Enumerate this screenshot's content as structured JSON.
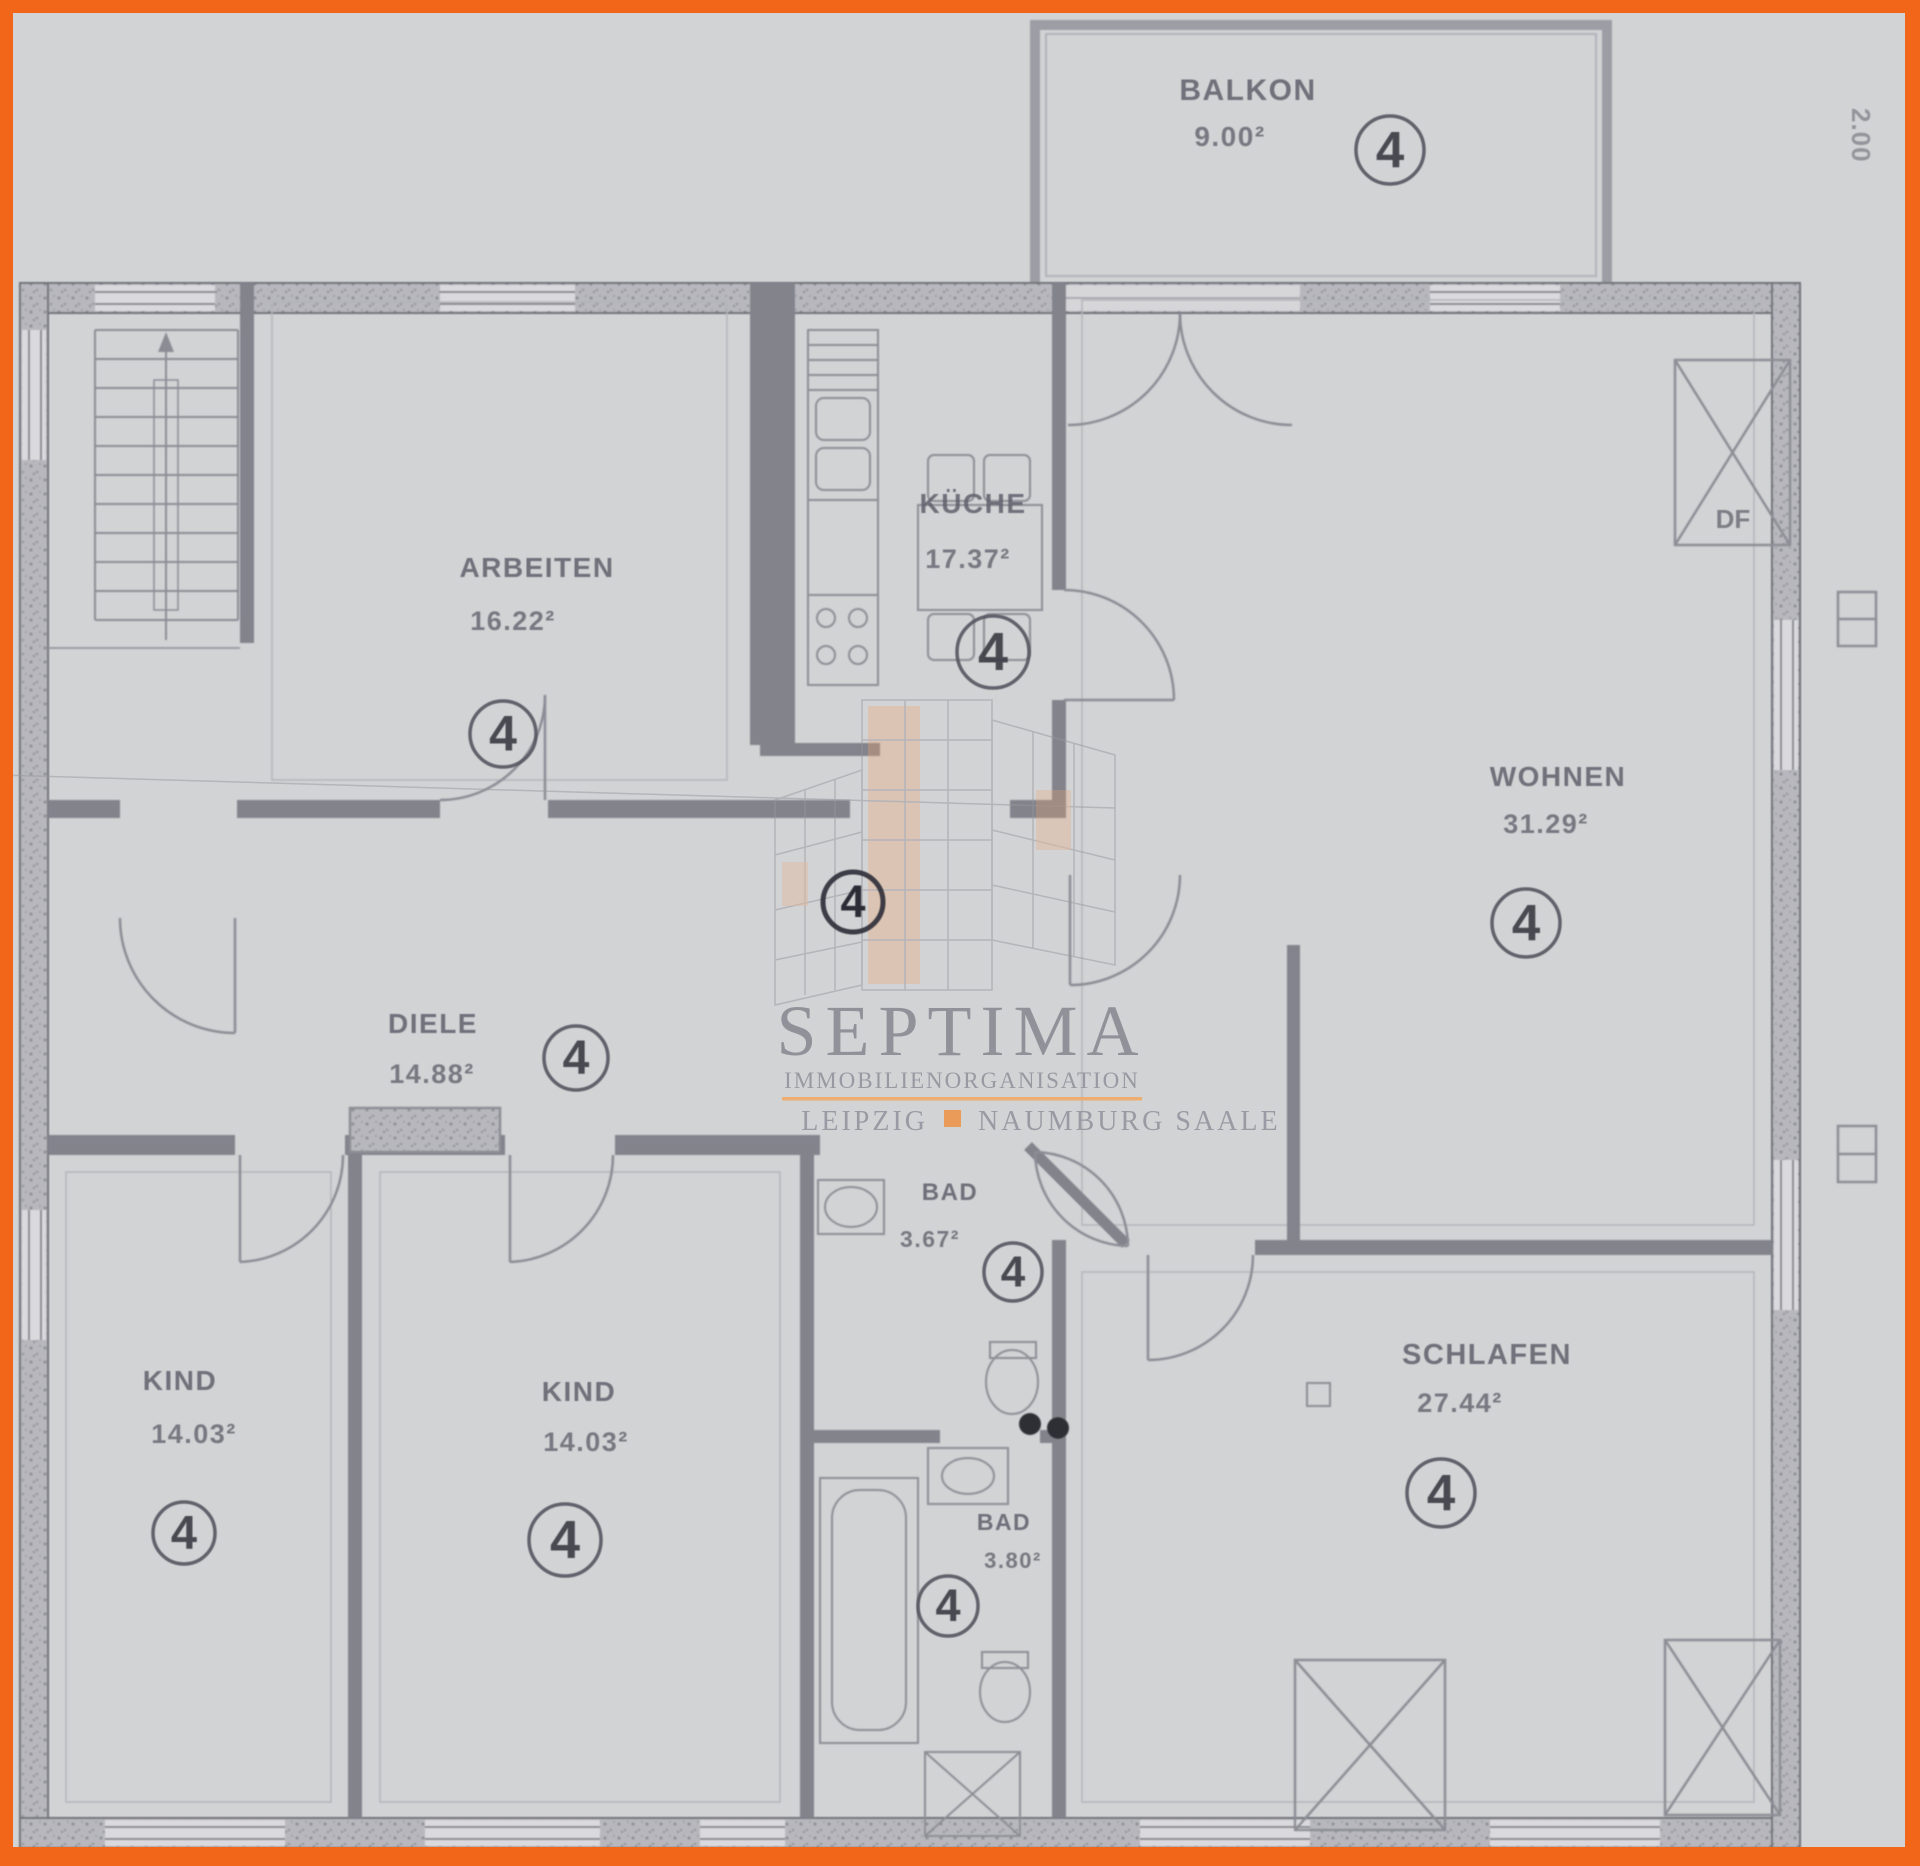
{
  "page": {
    "background": "#d2d3d5",
    "border_color": "#f2661a"
  },
  "plan": {
    "unit_number": "4",
    "side_dimension": "2.00",
    "duct_label": "DF",
    "rooms": [
      {
        "id": "balkon",
        "name": "BALKON",
        "area": "9.00²",
        "label": {
          "x": 1248,
          "y": 100,
          "s": 30
        },
        "area_pos": {
          "x": 1230,
          "y": 146,
          "s": 28
        },
        "circle": {
          "x": 1390,
          "y": 150,
          "r": 34
        }
      },
      {
        "id": "arbeiten",
        "name": "ARBEITEN",
        "area": "16.22²",
        "label": {
          "x": 537,
          "y": 577,
          "s": 28
        },
        "area_pos": {
          "x": 513,
          "y": 630,
          "s": 27
        },
        "circle": {
          "x": 503,
          "y": 734,
          "r": 33
        }
      },
      {
        "id": "kueche",
        "name": "KÜCHE",
        "area": "17.37²",
        "label": {
          "x": 973,
          "y": 513,
          "s": 28
        },
        "area_pos": {
          "x": 968,
          "y": 568,
          "s": 27
        },
        "circle": {
          "x": 993,
          "y": 652,
          "r": 36
        }
      },
      {
        "id": "wohnen",
        "name": "WOHNEN",
        "area": "31.29²",
        "label": {
          "x": 1558,
          "y": 786,
          "s": 28
        },
        "area_pos": {
          "x": 1546,
          "y": 833,
          "s": 27
        },
        "circle": {
          "x": 1526,
          "y": 923,
          "r": 34
        }
      },
      {
        "id": "diele",
        "name": "DIELE",
        "area": "14.88²",
        "label": {
          "x": 433,
          "y": 1033,
          "s": 28
        },
        "area_pos": {
          "x": 432,
          "y": 1083,
          "s": 27
        },
        "circle": {
          "x": 576,
          "y": 1058,
          "r": 32
        }
      },
      {
        "id": "kind-links",
        "name": "KIND",
        "area": "14.03²",
        "label": {
          "x": 180,
          "y": 1390,
          "s": 28
        },
        "area_pos": {
          "x": 194,
          "y": 1443,
          "s": 27
        },
        "circle": {
          "x": 184,
          "y": 1533,
          "r": 31
        }
      },
      {
        "id": "kind-mitte",
        "name": "KIND",
        "area": "14.03²",
        "label": {
          "x": 579,
          "y": 1401,
          "s": 28
        },
        "area_pos": {
          "x": 586,
          "y": 1451,
          "s": 27
        },
        "circle": {
          "x": 565,
          "y": 1540,
          "r": 36
        }
      },
      {
        "id": "bad-oben",
        "name": "BAD",
        "area": "3.67²",
        "label": {
          "x": 950,
          "y": 1200,
          "s": 24
        },
        "area_pos": {
          "x": 930,
          "y": 1247,
          "s": 23
        },
        "circle": {
          "x": 1013,
          "y": 1272,
          "r": 29
        }
      },
      {
        "id": "bad-unten",
        "name": "BAD",
        "area": "3.80²",
        "label": {
          "x": 1004,
          "y": 1530,
          "s": 23
        },
        "area_pos": {
          "x": 1013,
          "y": 1568,
          "s": 22
        },
        "circle": {
          "x": 948,
          "y": 1606,
          "r": 30
        }
      },
      {
        "id": "schlafen",
        "name": "SCHLAFEN",
        "area": "27.44²",
        "label": {
          "x": 1487,
          "y": 1364,
          "s": 29
        },
        "area_pos": {
          "x": 1460,
          "y": 1412,
          "s": 27
        },
        "circle": {
          "x": 1441,
          "y": 1493,
          "r": 34
        }
      }
    ],
    "extra_markers": [
      {
        "id": "flur",
        "x": 853,
        "y": 902,
        "r": 30
      }
    ]
  },
  "watermark": {
    "brand": "SEPTIMA",
    "subtitle": "IMMOBILIENORGANISATION",
    "city_left": "LEIPZIG",
    "city_right": "NAUMBURG SAALE",
    "accent": "#efa868"
  }
}
